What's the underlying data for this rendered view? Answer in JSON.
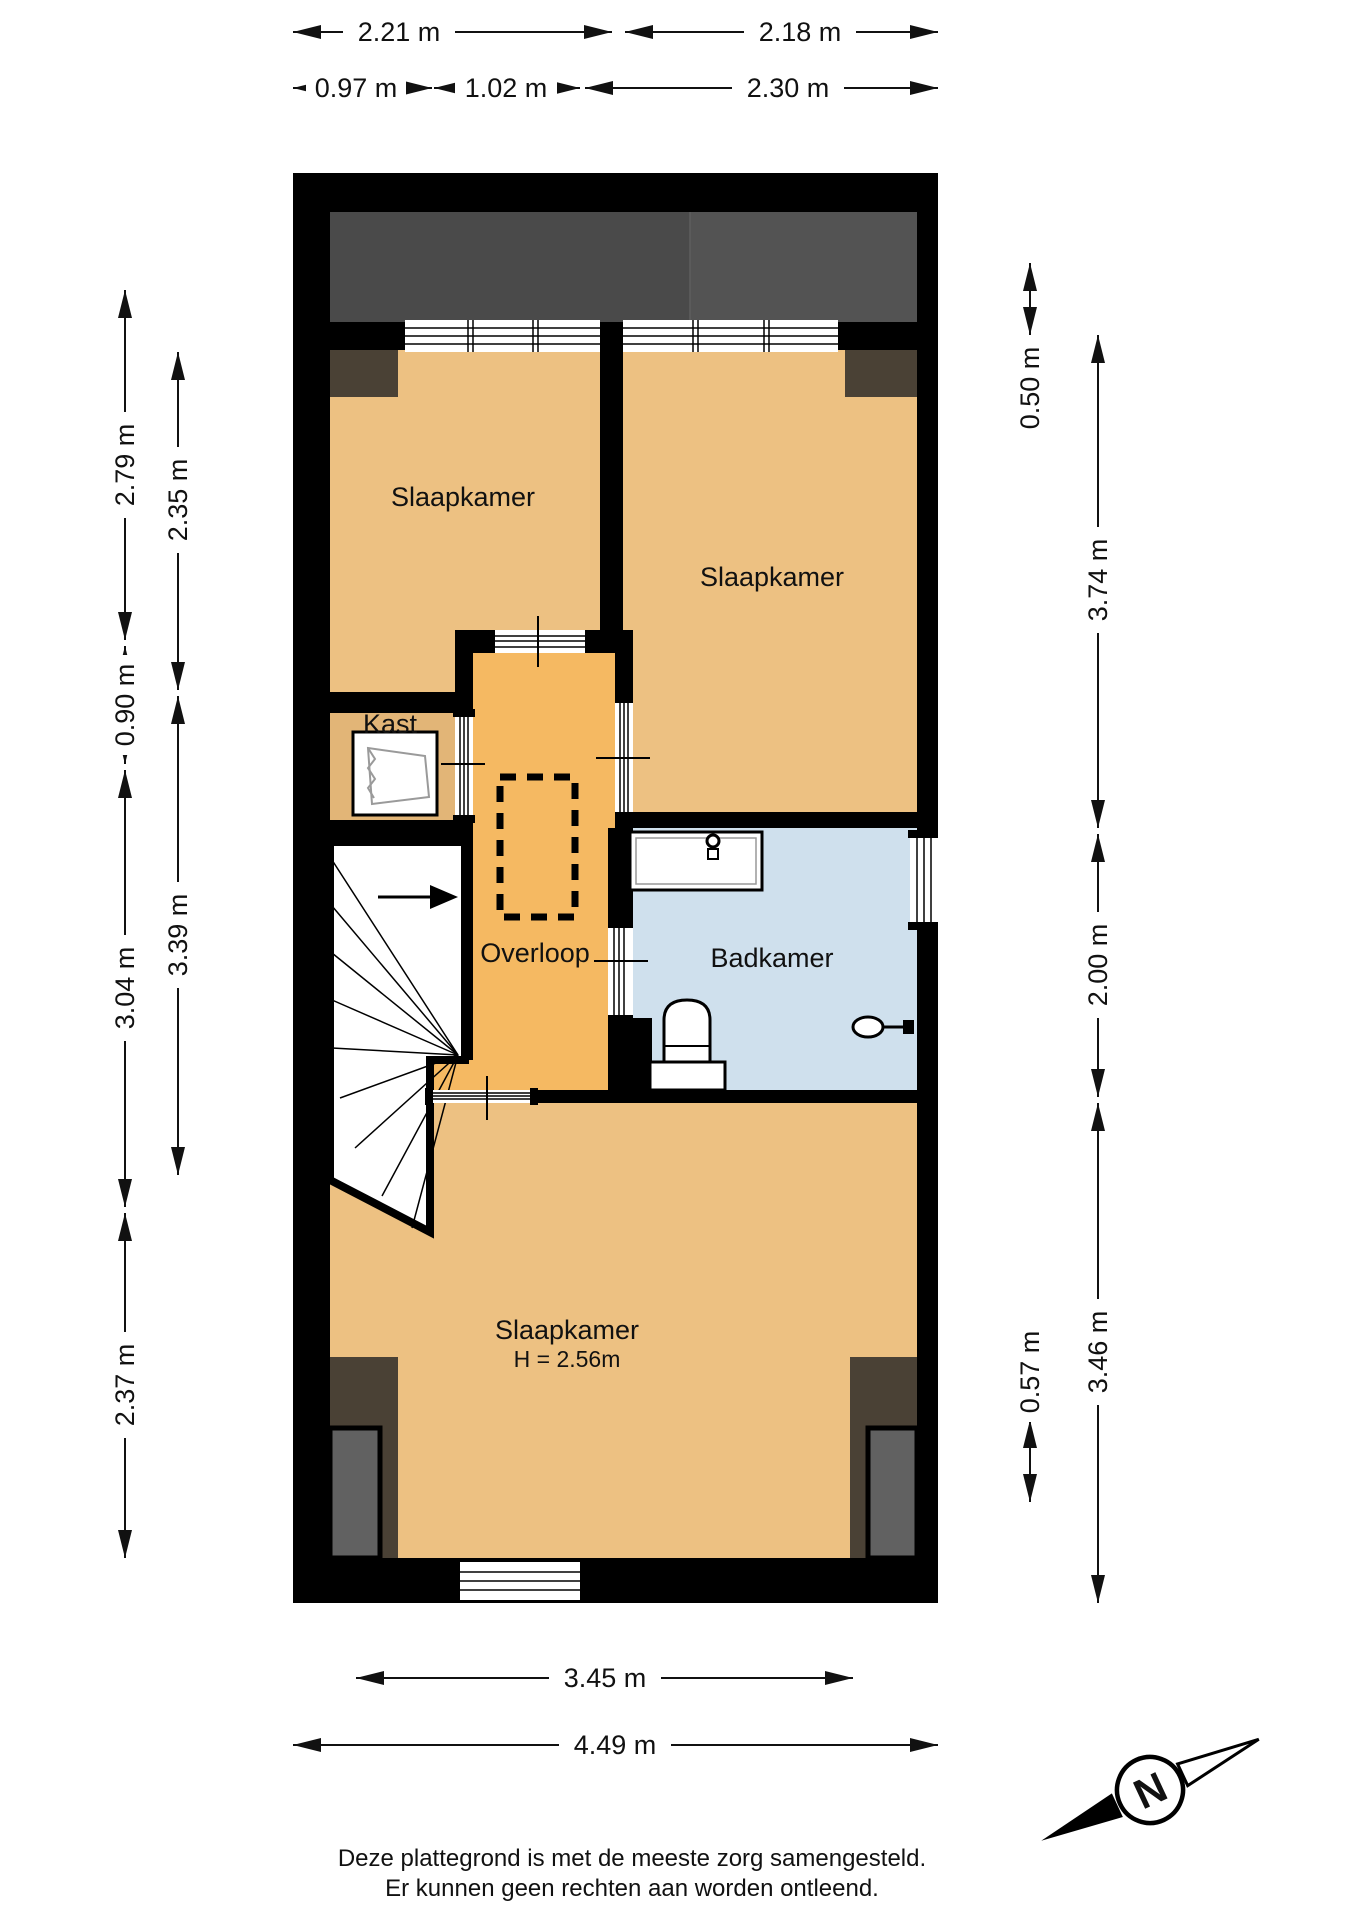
{
  "plan": {
    "rooms": {
      "bedroom_top_left": {
        "label": "Slaapkamer"
      },
      "bedroom_top_right": {
        "label": "Slaapkamer"
      },
      "bedroom_bottom": {
        "label": "Slaapkamer",
        "ceiling_height": "H = 2.56m"
      },
      "closet": {
        "label": "Kast"
      },
      "landing": {
        "label": "Overloop"
      },
      "bathroom": {
        "label": "Badkamer"
      }
    },
    "colors": {
      "room_floor": "#edc182",
      "landing_floor": "#f5b962",
      "closet_floor": "#e2b577",
      "bathroom_floor": "#cfe0ed",
      "roof": "#4a4a4a",
      "roof_light": "#535353",
      "dormer": "#4a4135",
      "dormer_inner": "#616161",
      "wall": "#000000"
    }
  },
  "dimensions": {
    "top_row1": [
      "2.21 m",
      "2.18 m"
    ],
    "top_row2": [
      "0.97 m",
      "1.02 m",
      "2.30 m"
    ],
    "left_outer": [
      "2.79 m",
      "0.90 m",
      "3.04 m",
      "2.37 m"
    ],
    "left_inner": [
      "2.35 m",
      "3.39 m"
    ],
    "right_outer": [
      "3.74 m",
      "2.00 m",
      "3.46 m"
    ],
    "right_inner": [
      "0.50 m",
      "0.57 m"
    ],
    "bottom": [
      "3.45 m",
      "4.49 m"
    ]
  },
  "compass": {
    "north": "N"
  },
  "footer": {
    "line1": "Deze plattegrond is met de meeste zorg samengesteld.",
    "line2": "Er kunnen geen rechten aan worden ontleend."
  }
}
